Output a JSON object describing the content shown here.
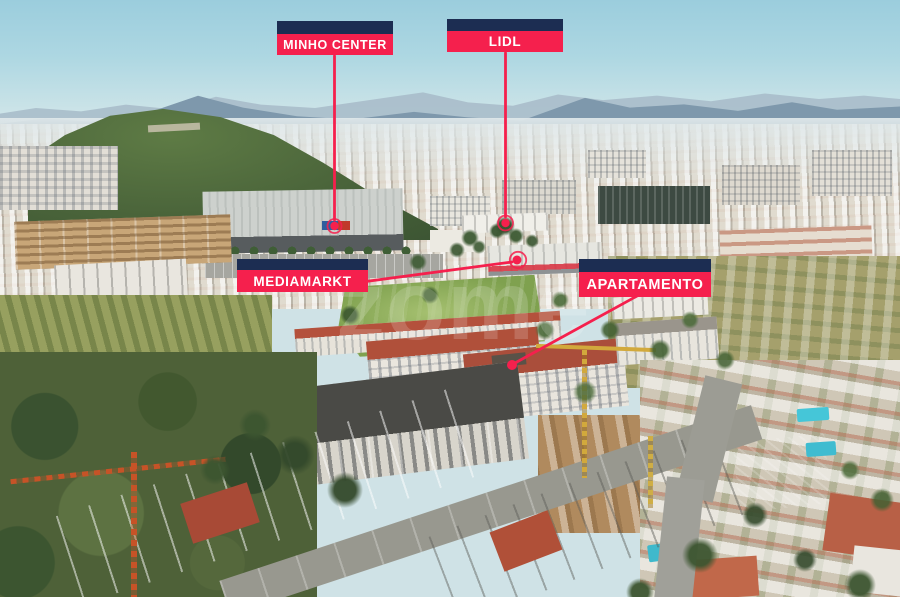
{
  "colors": {
    "accent": "#F5204D",
    "navy": "#1C2D52",
    "text": "#FFFFFF"
  },
  "watermark": {
    "text": "zome"
  },
  "labels": {
    "minho_center": {
      "text": "MINHO CENTER"
    },
    "lidl": {
      "text": "LIDL"
    },
    "mediamarkt": {
      "text": "MEDIAMARKT"
    },
    "apartamento": {
      "text": "APARTAMENTO"
    }
  }
}
